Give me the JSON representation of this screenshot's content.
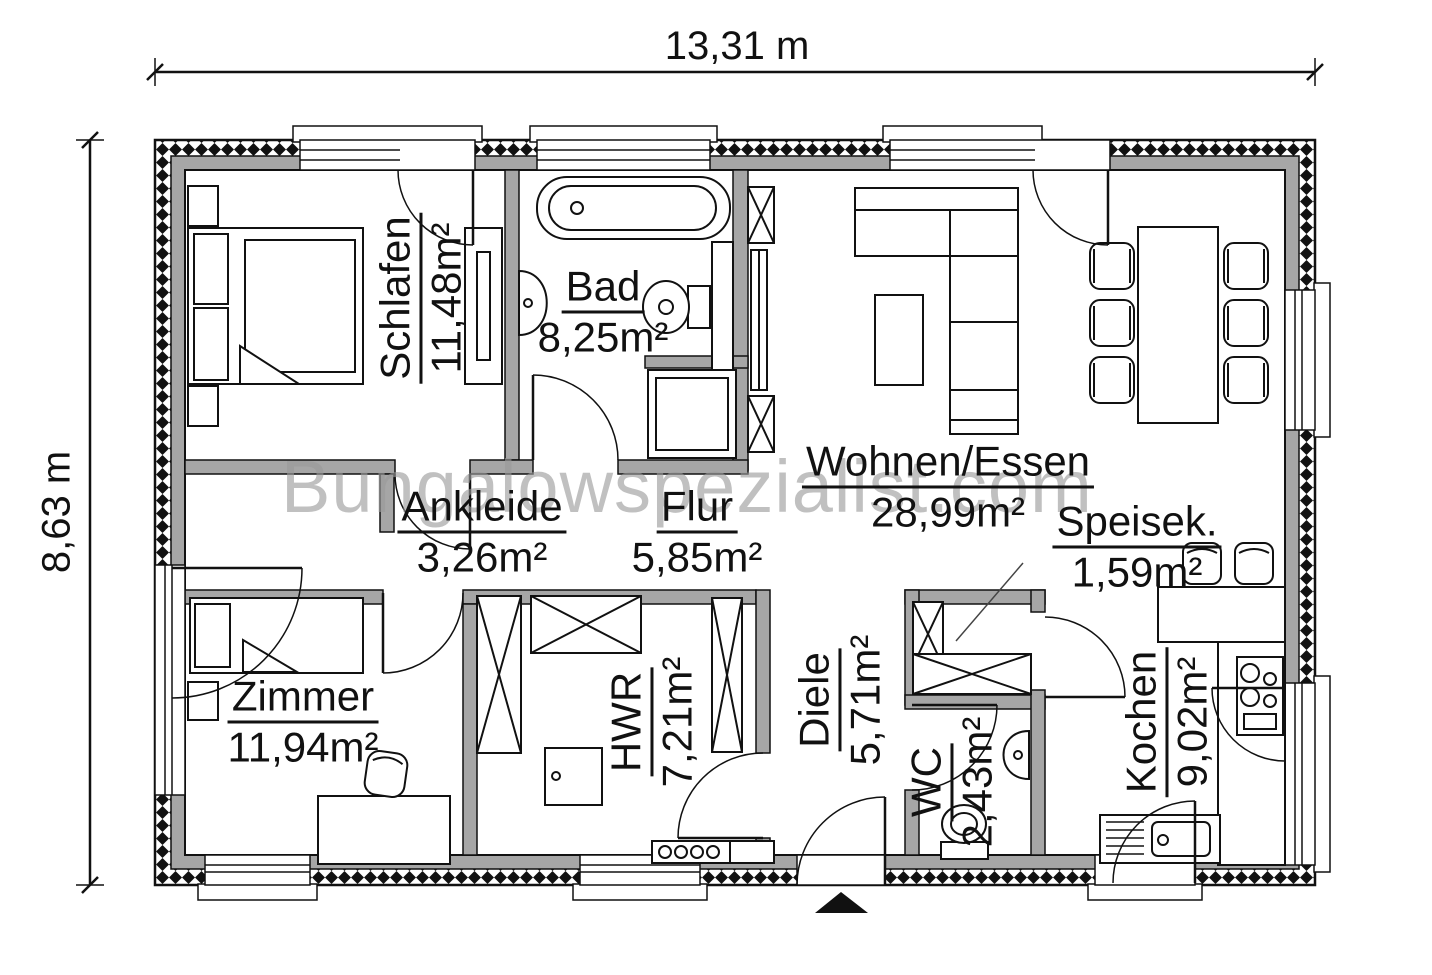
{
  "plan": {
    "watermark": "Bungalowspezialist.com",
    "dimensions": {
      "width": "13,31 m",
      "height": "8,63 m"
    },
    "rooms": [
      {
        "name": "Schlafen",
        "area": "11,48m²"
      },
      {
        "name": "Bad",
        "area": "8,25m²"
      },
      {
        "name": "Wohnen/Essen",
        "area": "28,99m²"
      },
      {
        "name": "Ankleide",
        "area": "3,26m²"
      },
      {
        "name": "Flur",
        "area": "5,85m²"
      },
      {
        "name": "Speisek.",
        "area": "1,59m²"
      },
      {
        "name": "Zimmer",
        "area": "11,94m²"
      },
      {
        "name": "HWR",
        "area": "7,21m²"
      },
      {
        "name": "Diele",
        "area": "5,71m²"
      },
      {
        "name": "WC",
        "area": "2,43m²"
      },
      {
        "name": "Kochen",
        "area": "9,02m²"
      }
    ],
    "colors": {
      "wall_fill": "#a6a6a6",
      "line": "#111111",
      "watermark": "#9a9a9a",
      "background": "#ffffff"
    }
  }
}
